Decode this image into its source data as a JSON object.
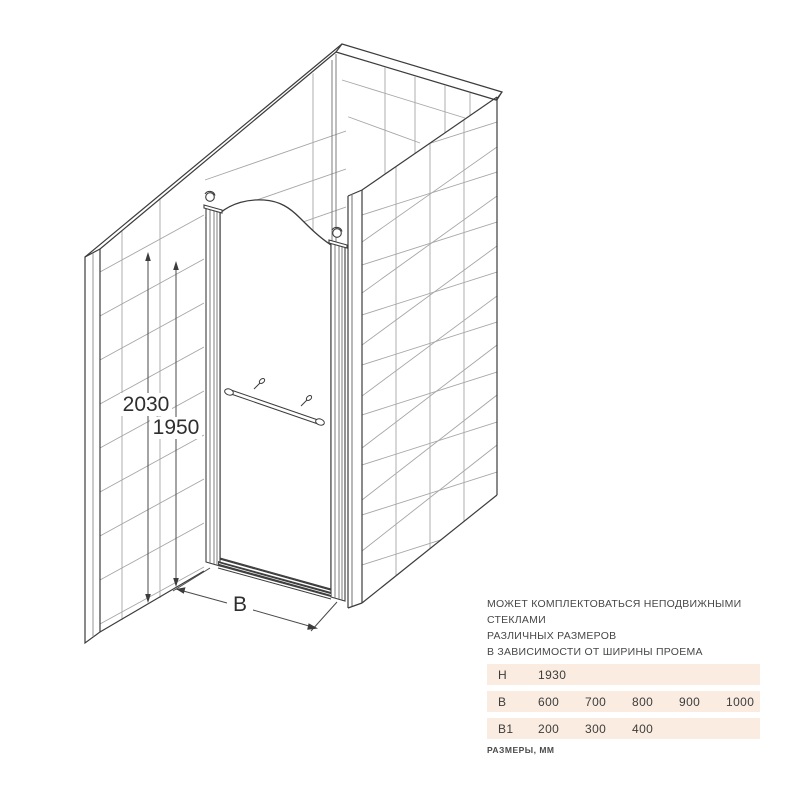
{
  "drawing": {
    "dims": {
      "wall_height": "2030",
      "door_height": "1950",
      "width_label": "B"
    }
  },
  "description": {
    "line1": "МОЖЕТ КОМПЛЕКТОВАТЬСЯ НЕПОДВИЖНЫМИ СТЕКЛАМИ",
    "line2": "РАЗЛИЧНЫХ РАЗМЕРОВ",
    "line3": "В ЗАВИСИМОСТИ ОТ ШИРИНЫ ПРОЕМА"
  },
  "size_table": {
    "rows": [
      {
        "label": "H",
        "values": [
          "1930",
          "",
          "",
          "",
          ""
        ]
      },
      {
        "label": "B",
        "values": [
          "600",
          "700",
          "800",
          "900",
          "1000"
        ]
      },
      {
        "label": "B1",
        "values": [
          "200",
          "300",
          "400",
          "",
          ""
        ]
      }
    ],
    "caption": "РАЗМЕРЫ, ММ"
  },
  "colors": {
    "table_row_bg": "#FAECE0",
    "edge_line": "#3c3c3c",
    "tile_line": "#a6a6a6",
    "text": "#474747"
  }
}
